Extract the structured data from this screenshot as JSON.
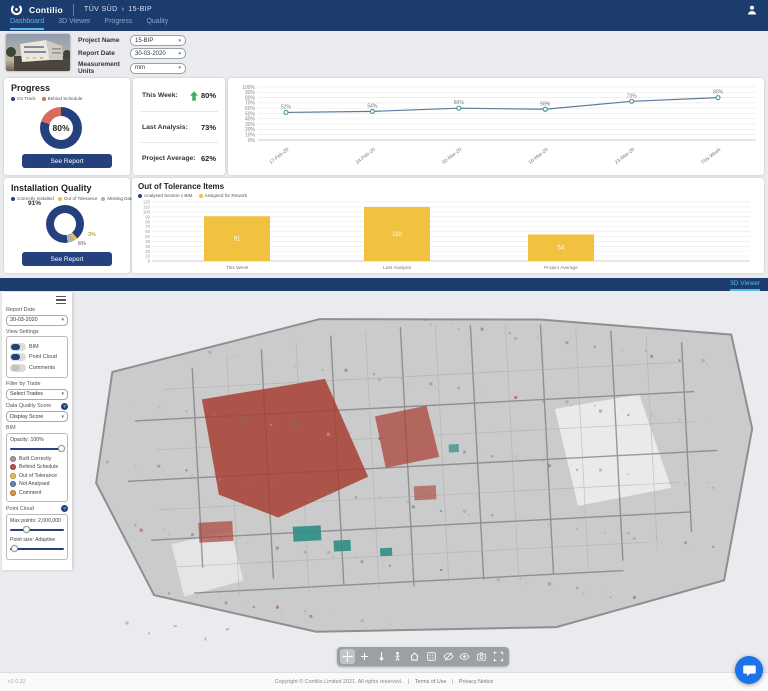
{
  "icons": {
    "chevron_down": "▾",
    "help": "?"
  },
  "header": {
    "brand": "Contilio",
    "org": "TÜV SÜD",
    "separator": "›",
    "project": "15-BIP",
    "tabs": [
      {
        "label": "Dashboard",
        "active": true
      },
      {
        "label": "3D Viewer",
        "active": false
      },
      {
        "label": "Progress",
        "active": false
      },
      {
        "label": "Quality",
        "active": false
      }
    ]
  },
  "filters": {
    "project_name_label": "Project Name",
    "project_name_value": "15-BIP",
    "report_date_label": "Report Date",
    "report_date_value": "30-03-2020",
    "units_label": "Measurement Units",
    "units_value": "mm"
  },
  "progress_card": {
    "title": "Progress",
    "see_report": "See Report",
    "stats": [
      {
        "label": "This Week:",
        "value": "80%",
        "trend": "up"
      },
      {
        "label": "Last Analysis:",
        "value": "73%",
        "trend": ""
      },
      {
        "label": "Project Average:",
        "value": "62%",
        "trend": ""
      }
    ]
  },
  "quality_card": {
    "title": "Installation Quality",
    "see_report": "See Report"
  },
  "chart_data": [
    {
      "id": "progress_donut",
      "type": "pie",
      "title": "Progress",
      "center_label": "80%",
      "start_angle": 0,
      "segments": [
        {
          "label": "On Track",
          "value": 80,
          "color": "#24417e"
        },
        {
          "label": "Behind Schedule",
          "value": 20,
          "color": "#d96b5f"
        }
      ],
      "legend_position": "top"
    },
    {
      "id": "progress_trend",
      "type": "line",
      "x": [
        "17-Feb-20",
        "24-Feb-20",
        "02-Mar-20",
        "16-Mar-20",
        "23-Mar-20",
        "This Week"
      ],
      "values": [
        52,
        54,
        60,
        58,
        73,
        80
      ],
      "point_labels": [
        "52%",
        "54%",
        "60%",
        "58%",
        "73%",
        "80%"
      ],
      "ylim": [
        0,
        100
      ],
      "ytick_step": 10,
      "line_color": "#5b7a9d",
      "point_color": "#4f9e94",
      "grid": true
    },
    {
      "id": "quality_donut",
      "type": "pie",
      "title": "Installation Quality",
      "start_angle": 172,
      "segments": [
        {
          "label": "Correctly Installed",
          "value": 91,
          "color": "#24417e"
        },
        {
          "label": "Out of Tolerance",
          "value": 3,
          "color": "#e8c24a"
        },
        {
          "label": "Missing Data",
          "value": 6,
          "color": "#b0b0b0"
        }
      ],
      "callouts": [
        "91%",
        "3%",
        "6%"
      ],
      "legend_position": "top"
    },
    {
      "id": "tolerance_bars",
      "type": "bar",
      "title": "Out of Tolerance Items",
      "legend": [
        {
          "label": "Analysed Section v BIM",
          "color": "#24417e"
        },
        {
          "label": "Assigned for Rework",
          "color": "#f0c240"
        }
      ],
      "categories": [
        "This Week",
        "Last Analysis",
        "Project Average"
      ],
      "values": [
        91,
        110,
        54
      ],
      "bar_color": "#f0c240",
      "ylim": [
        0,
        120
      ],
      "ytick_step": 10,
      "grid": true
    }
  ],
  "viewer": {
    "tab_label": "3D Viewer",
    "panel": {
      "report_date_label": "Report Date",
      "report_date_value": "30-03-2020",
      "view_settings_label": "View Settings",
      "toggles": [
        {
          "label": "BIM",
          "on": true
        },
        {
          "label": "Point Cloud",
          "on": true
        },
        {
          "label": "Comments",
          "on": false
        }
      ],
      "filter_label": "Filter by Trade",
      "filter_value": "Select Trades",
      "dqs_label": "Data Quality Score",
      "dqs_value": "Display Score",
      "bim_label": "BIM",
      "opacity_label": "Opacity: 100%",
      "opacity_percent": 100,
      "bim_legend": [
        {
          "label": "Built Correctly",
          "color": "#a0a0a0"
        },
        {
          "label": "Behind Schedule",
          "color": "#c0504d"
        },
        {
          "label": "Out of Tolerance",
          "color": "#e8c24a"
        },
        {
          "label": "Not Analysed",
          "color": "#5b87b0"
        },
        {
          "label": "Comment",
          "color": "#e09440"
        }
      ],
      "point_cloud_label": "Point Cloud",
      "max_points_label": "Max points: 2,000,000",
      "max_points_percent": 28,
      "point_size_label": "Point size: Adaptive",
      "point_size_percent": 3
    },
    "toolbar": [
      {
        "name": "orbit",
        "active": true
      },
      {
        "name": "pan",
        "active": false
      },
      {
        "name": "drop",
        "active": false
      },
      {
        "name": "first-person",
        "active": false
      },
      {
        "name": "home",
        "active": false
      },
      {
        "name": "fit-view",
        "active": false
      },
      {
        "name": "hide-objects",
        "active": false
      },
      {
        "name": "show-objects",
        "active": false
      },
      {
        "name": "screenshot",
        "active": false
      },
      {
        "name": "fullscreen",
        "active": false
      }
    ]
  },
  "footer": {
    "version": "v2.0.32",
    "copyright": "Copyright © Contilio Limited 2021. All rights reserved.",
    "sep": "|",
    "links": [
      "Terms of Use",
      "Privacy Notice"
    ]
  }
}
